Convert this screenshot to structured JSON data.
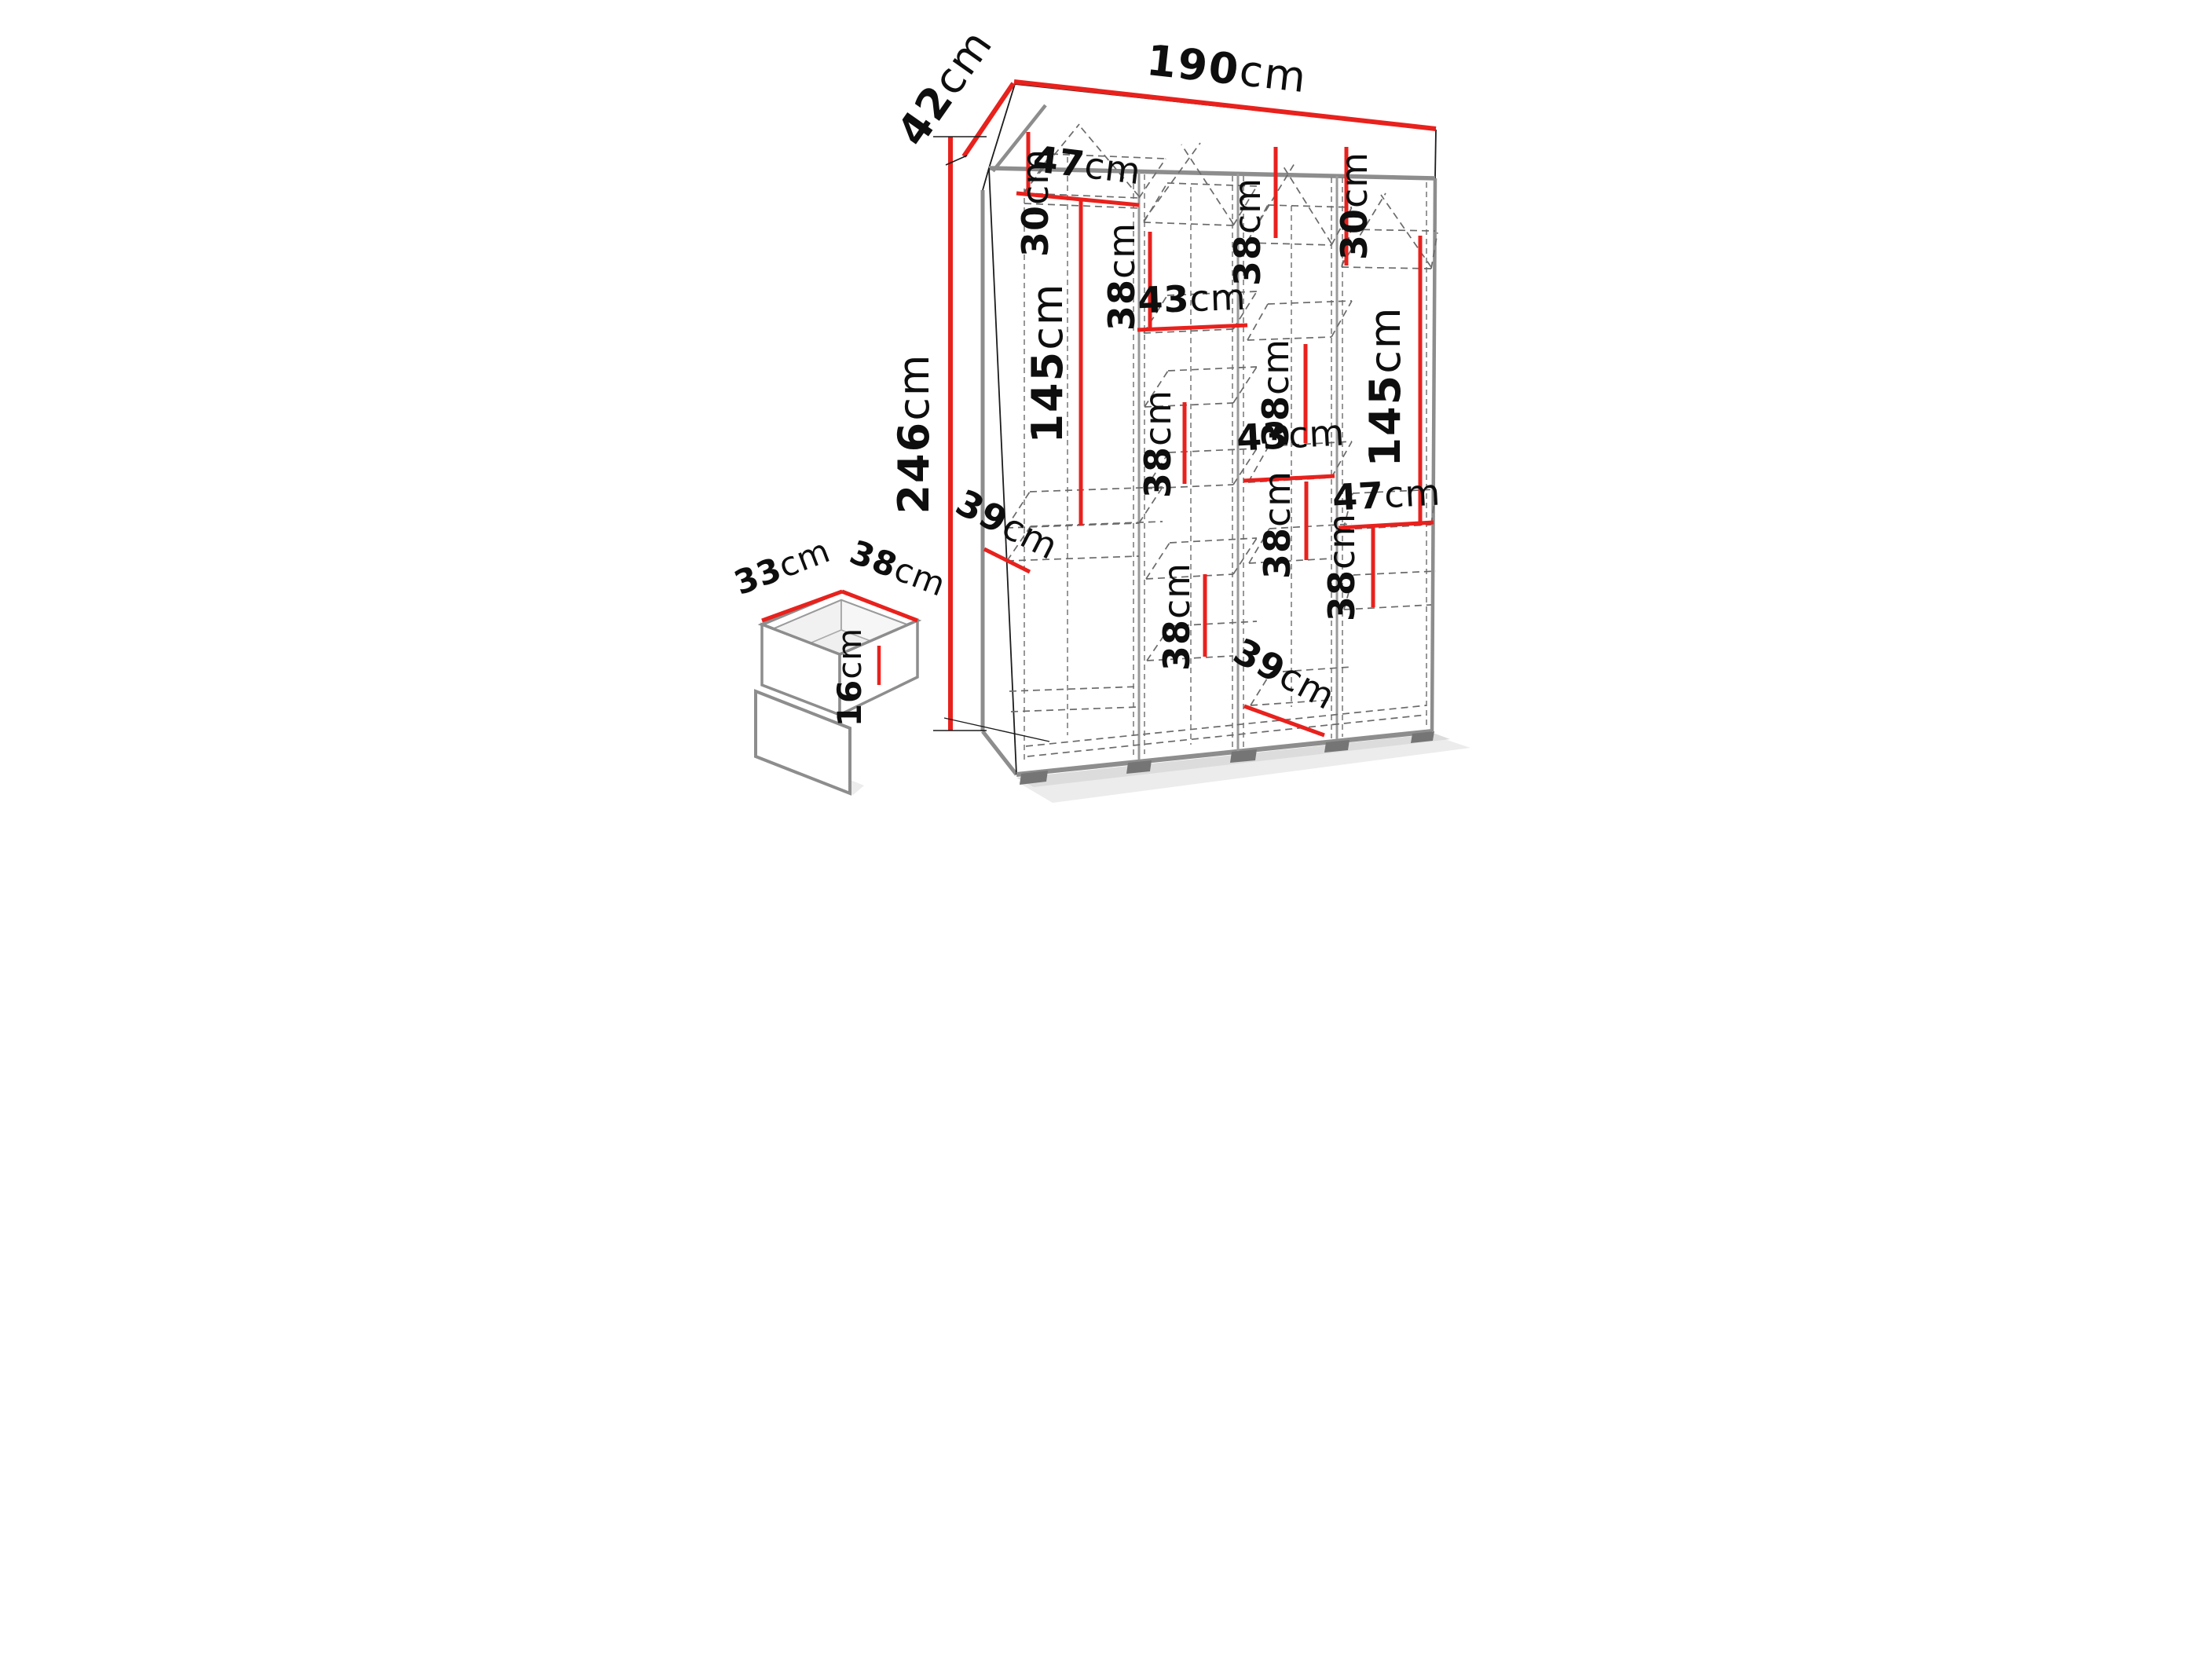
{
  "diagram": {
    "type": "furniture-dimension-diagram",
    "subject": "four-section wardrobe with internal shelves, hanging spaces and drawer detail",
    "unit": "cm",
    "colors": {
      "dimension_line": "#e8211d",
      "outline": "#1c1c1c",
      "panel_edge": "#8d8d8d",
      "dashed_line": "#6a6a6a",
      "text": "#0e0e0e",
      "background": "#ffffff"
    },
    "overall": {
      "width_cm": 190,
      "height_cm": 246,
      "depth_cm": 42
    },
    "drawer_detail": {
      "depth_cm": 33,
      "width_cm": 38,
      "height_cm": 16
    },
    "dims": {
      "width190": {
        "value": "190",
        "unit": "cm"
      },
      "depth42": {
        "value": "42",
        "unit": "cm"
      },
      "height246": {
        "value": "246",
        "unit": "cm"
      },
      "col1_top30": {
        "value": "30",
        "unit": "cm"
      },
      "col1_shelf47": {
        "value": "47",
        "unit": "cm"
      },
      "col1_hang145": {
        "value": "145",
        "unit": "cm"
      },
      "col1_depth39": {
        "value": "39",
        "unit": "cm"
      },
      "col2_gap38_top": {
        "value": "38",
        "unit": "cm"
      },
      "col2_shelf43": {
        "value": "43",
        "unit": "cm"
      },
      "col2_gap38_mid": {
        "value": "38",
        "unit": "cm"
      },
      "col2_gap38_low": {
        "value": "38",
        "unit": "cm"
      },
      "col3_gap38_top": {
        "value": "38",
        "unit": "cm"
      },
      "col3_gap38_mid": {
        "value": "38",
        "unit": "cm"
      },
      "col3_shelf43": {
        "value": "43",
        "unit": "cm"
      },
      "col3_gap38_low": {
        "value": "38",
        "unit": "cm"
      },
      "col3_depth39": {
        "value": "39",
        "unit": "cm"
      },
      "col4_top30": {
        "value": "30",
        "unit": "cm"
      },
      "col4_hang145": {
        "value": "145",
        "unit": "cm"
      },
      "col4_shelf47": {
        "value": "47",
        "unit": "cm"
      },
      "col4_gap38": {
        "value": "38",
        "unit": "cm"
      },
      "drawer_depth33": {
        "value": "33",
        "unit": "cm"
      },
      "drawer_width38": {
        "value": "38",
        "unit": "cm"
      },
      "drawer_height16": {
        "value": "16",
        "unit": "cm"
      }
    }
  }
}
